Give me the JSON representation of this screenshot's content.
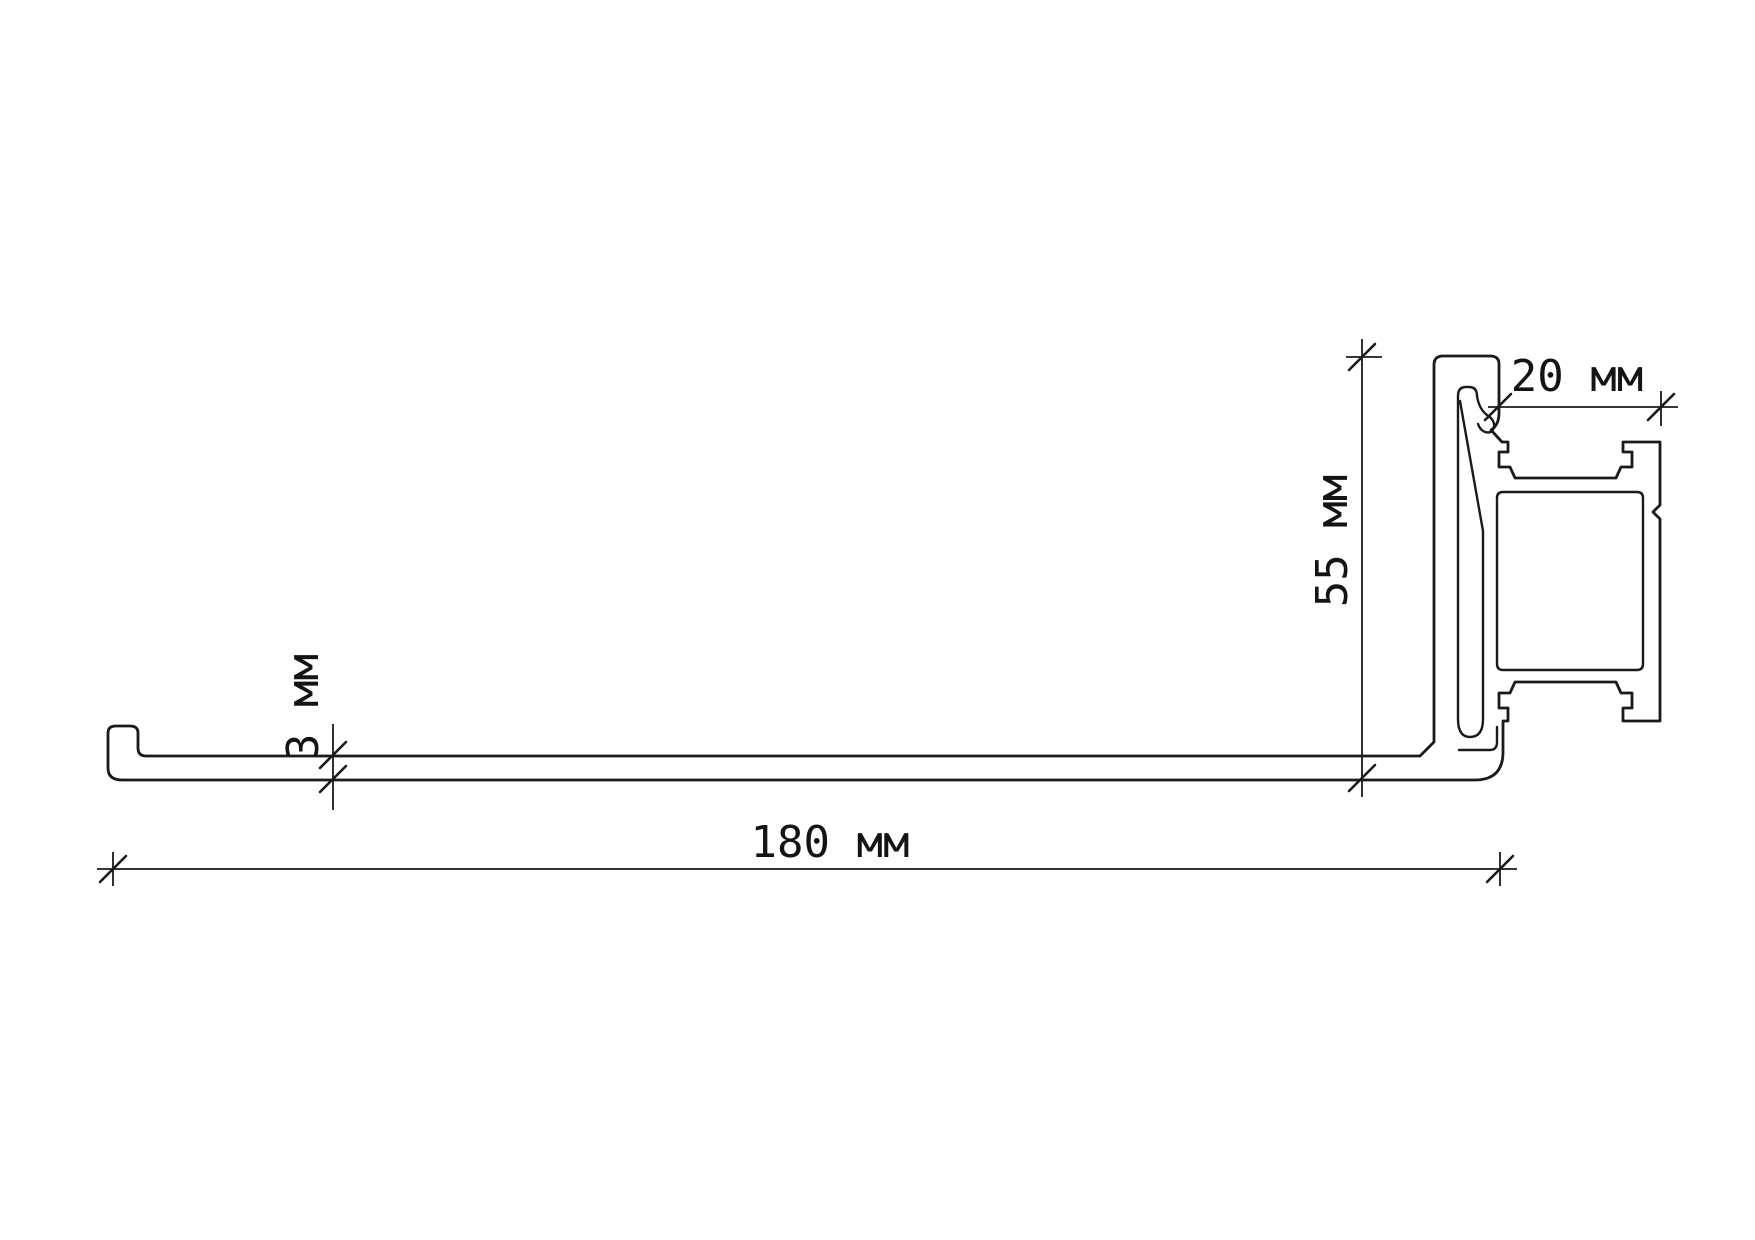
{
  "drawing": {
    "background": "#ffffff",
    "line_color": "#1a1a1a",
    "units": "мм",
    "dimensions": {
      "length": {
        "value": 180,
        "unit": "мм",
        "label": "180 мм"
      },
      "height": {
        "value": 55,
        "unit": "мм",
        "label": "55 мм"
      },
      "top_width": {
        "value": 20,
        "unit": "мм",
        "label": "20 мм"
      },
      "sheet_thickness": {
        "value": 3,
        "unit": "мм",
        "label": "3 мм"
      }
    }
  }
}
